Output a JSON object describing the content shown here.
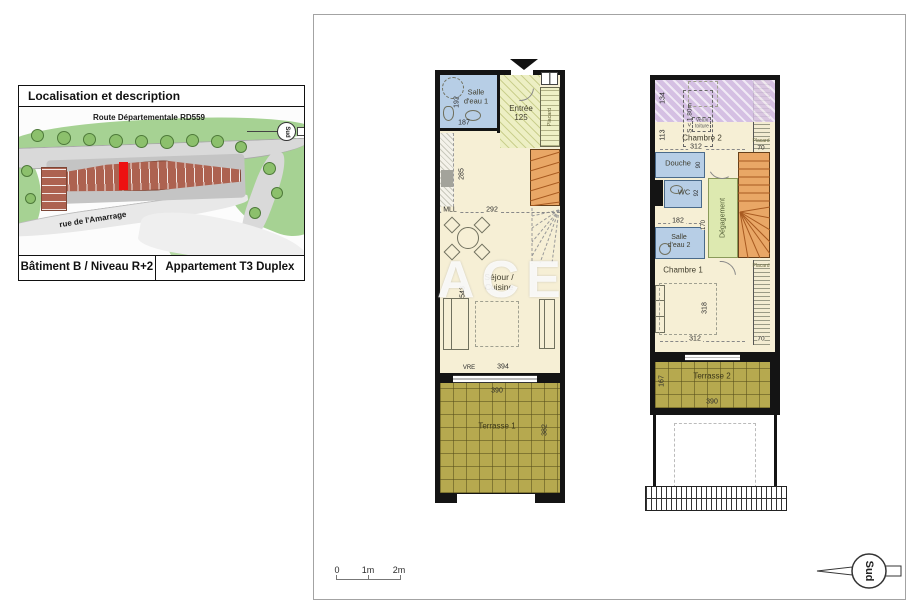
{
  "colors": {
    "wall": "#141414",
    "wet_room_blue": "#b7cee6",
    "floor_cream": "#f6efd5",
    "terrace_olive": "#b6a94f",
    "stairs_orange": "#e9a766",
    "low_ceiling_purple": "#d5c0e3",
    "hallway_green": "#dde9b0",
    "highlight_red": "#ee1111",
    "map_green": "#9ccb86"
  },
  "location_box": {
    "title": "Localisation et description",
    "road_label": "Route Départementale RD559",
    "street_label": "rue de l'Amarrage",
    "compass_label": "Sud",
    "building_label": "Bâtiment B / Niveau R+2",
    "apartment_label": "Appartement T3 Duplex"
  },
  "sheet": {
    "watermark": "ACE",
    "scale_labels": {
      "zero": "0",
      "one": "1m",
      "two": "2m"
    },
    "compass_label": "Sud"
  },
  "plan1": {
    "salle_eau1": {
      "line1": "Salle",
      "line2": "d'eau 1",
      "height": "192",
      "width": "187"
    },
    "entree": {
      "label": "Entrée",
      "dim": "125"
    },
    "placard": {
      "label": "Placard"
    },
    "kitchen_depth": "285",
    "mll": "MLL",
    "width_dim": "292",
    "sejour": {
      "line1": "Séjour /",
      "line2": "Cuisine",
      "height": "543"
    },
    "vre": "VRE",
    "bottom_dim": "394",
    "terrasse1": {
      "label": "Terrasse 1",
      "width": "390",
      "height": "382"
    }
  },
  "plan2": {
    "slope": {
      "dim": "134",
      "label": "S < 1.80m",
      "velux1": "Velux",
      "velux2": "toiture"
    },
    "under_slope_dim": "113",
    "chambre2": {
      "label": "Chambre 2",
      "width": "312"
    },
    "placard_top": {
      "label": "Placard",
      "width": "70"
    },
    "douche": {
      "label": "Douche",
      "dim": "90"
    },
    "wc": {
      "label": "WC",
      "dim": "92"
    },
    "dim182": "182",
    "salle_eau2": {
      "line1": "Salle",
      "line2": "d'eau 2",
      "dim": "170"
    },
    "degagement": "Dégagement",
    "chambre1": {
      "label": "Chambre 1",
      "height": "318",
      "width": "312"
    },
    "placard_bottom": {
      "label": "Placard",
      "width": "70"
    },
    "terrasse2": {
      "label": "Terrasse 2",
      "height": "167",
      "width": "390"
    }
  }
}
